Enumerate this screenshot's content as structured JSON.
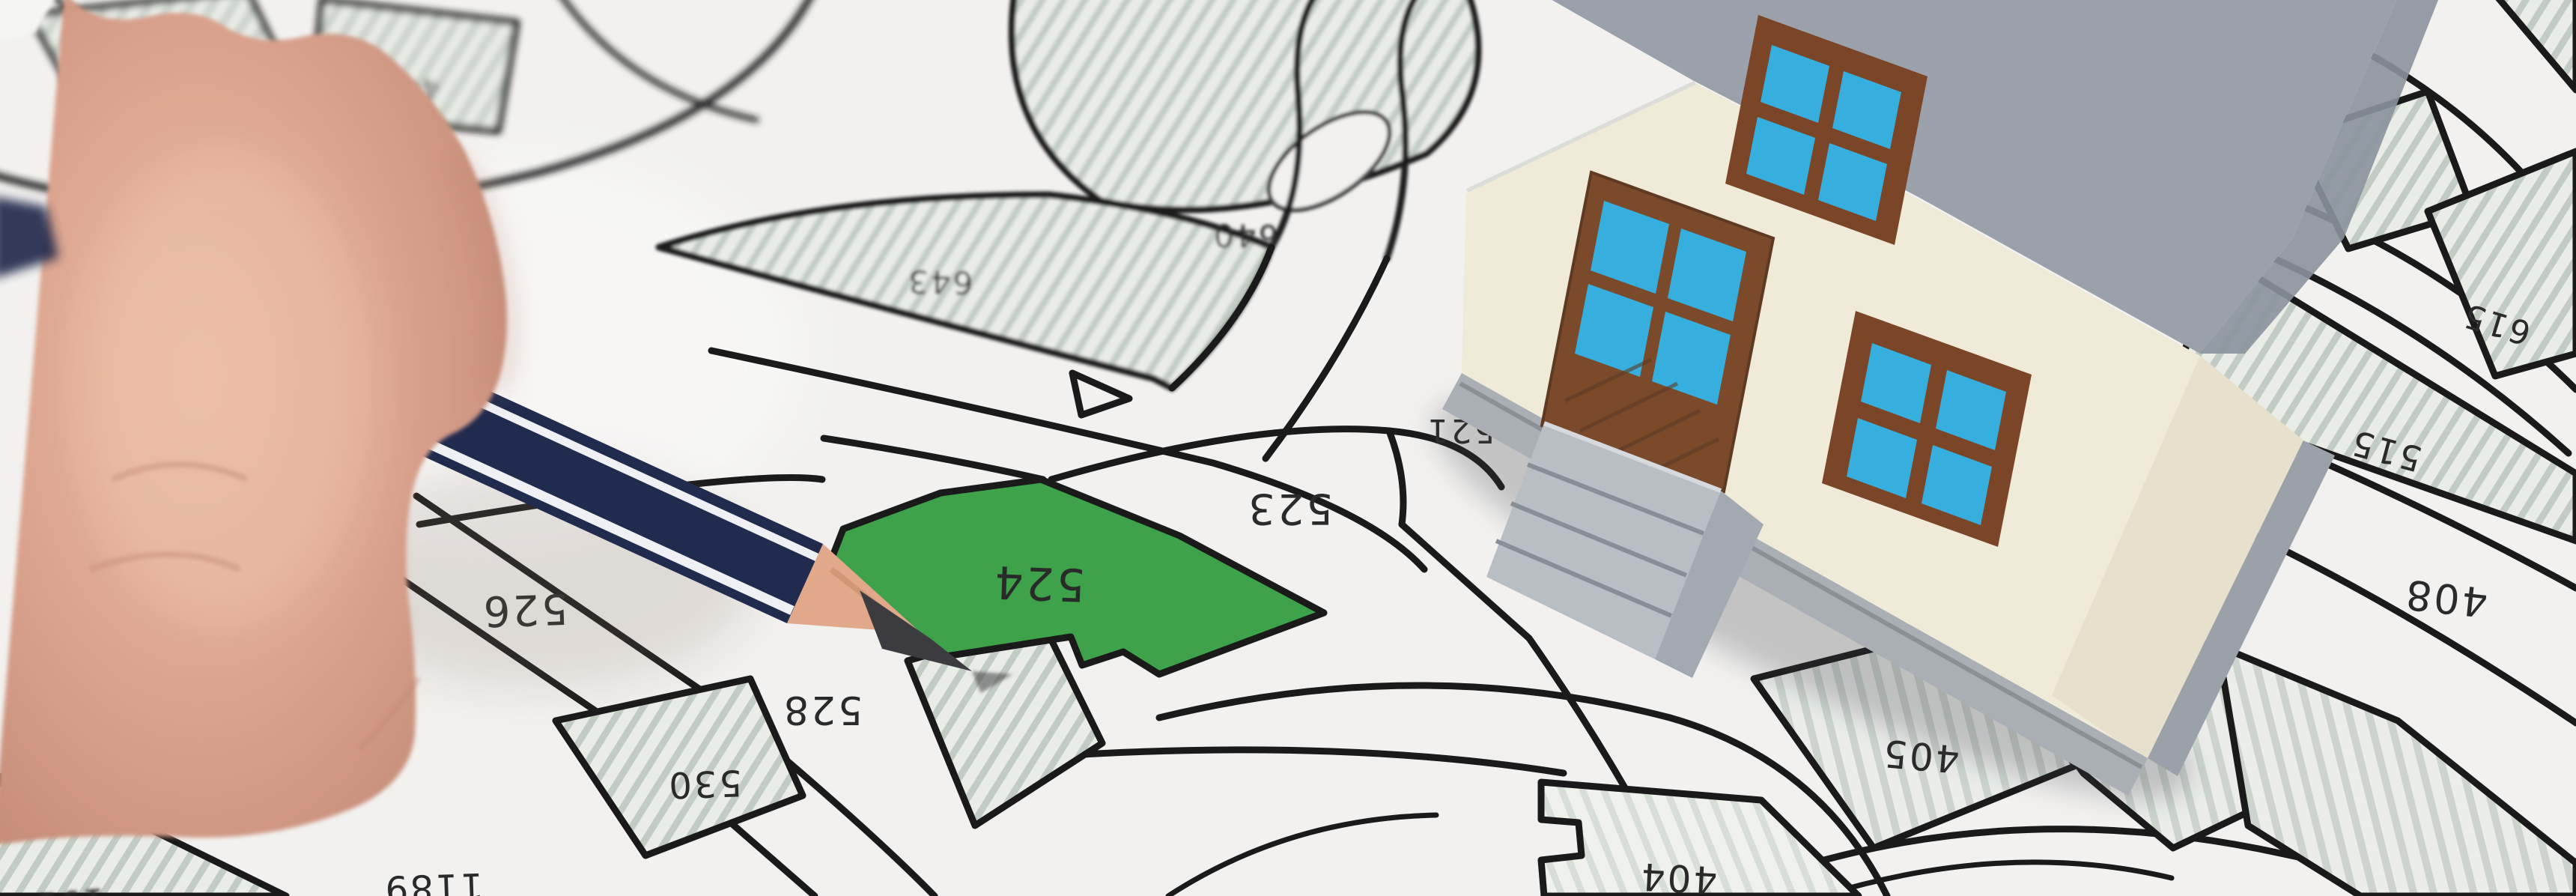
{
  "map": {
    "labels": {
      "p524": "524",
      "p523": "523",
      "p521": "521",
      "p526": "526",
      "p528": "528",
      "p530": "530",
      "p1189": "1189",
      "p404": "404",
      "p405": "405",
      "p406": "406",
      "p408": "408",
      "p515": "515",
      "p615": "615",
      "p643": "643",
      "p640": "640",
      "p848": "848",
      "p448": "448",
      "p191": "191"
    },
    "highlighted_parcel": "524"
  },
  "colors": {
    "paper": "#f2f1ef",
    "line": "#1a1a1a",
    "green": "#3da24a",
    "roof": "#9aa1ab",
    "rooflight": "#c9cdd4",
    "fascia": "#dcdcd8",
    "wall": "#f0ead9",
    "wallshade": "#e3dcc8",
    "foundation": "#a9afb5",
    "foundation2": "#9ba1a8",
    "step": "#b9bec4",
    "stepside": "#a3a9b0",
    "brown": "#7b4527",
    "doorbrown": "#7a4a2b",
    "glass": "#36aede",
    "navy": "#202b4e",
    "pstripe": "#eef0f4",
    "wood": "#e2a88a",
    "graphite": "#3c3c40",
    "skin": "#d9a18c",
    "skinlight": "#f0c6ad",
    "skindark": "#bc8270",
    "cuff": "#f5f5f3"
  }
}
